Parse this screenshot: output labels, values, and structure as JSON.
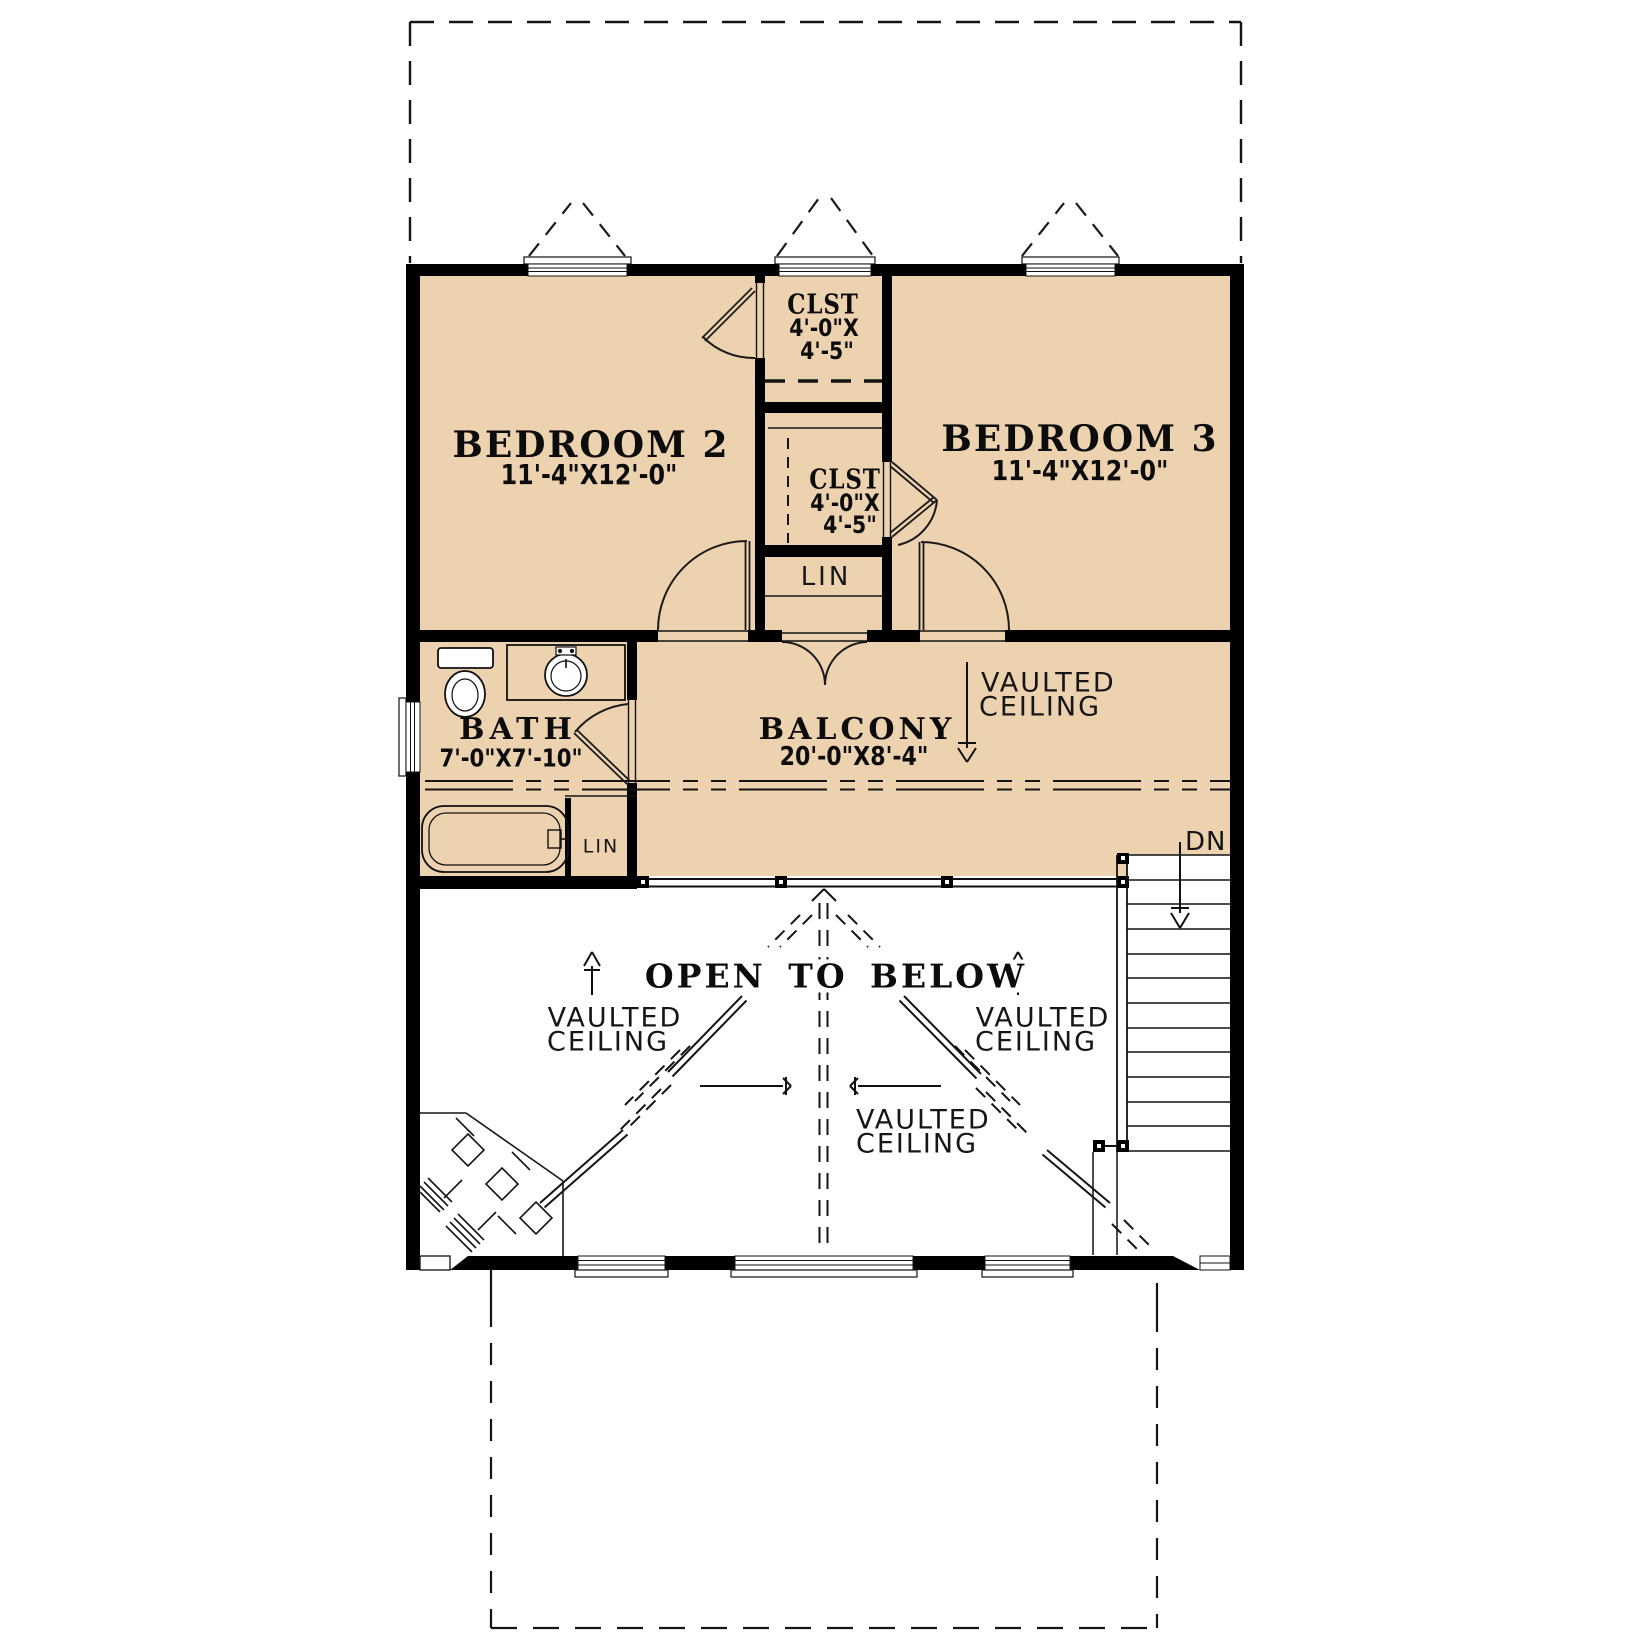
{
  "plan": {
    "colors": {
      "floor_tan": "#edd2b0",
      "wall": "#000000",
      "line": "#111111"
    }
  },
  "rooms": {
    "bedroom2": {
      "name": "BEDROOM 2",
      "dims": "11'-4\"X12'-0\""
    },
    "bedroom3": {
      "name": "BEDROOM 3",
      "dims": "11'-4\"X12'-0\""
    },
    "closet_top": {
      "name": "CLST",
      "dims_w": "4'-0\"X",
      "dims_h": "4'-5\""
    },
    "closet_mid": {
      "name": "CLST",
      "dims_w": "4'-0\"X",
      "dims_h": "4'-5\""
    },
    "bath": {
      "name": "BATH",
      "dims": "7'-0\"X7'-10\""
    },
    "balcony": {
      "name": "BALCONY",
      "dims": "20'-0\"X8'-4\""
    },
    "linen_hall": {
      "name": "LIN"
    },
    "linen_bath": {
      "name": "LIN"
    }
  },
  "annotations": {
    "open_to_below": "OPEN TO BELOW",
    "vaulted_line1": "VAULTED",
    "vaulted_line2": "CEILING",
    "down": "DN"
  }
}
